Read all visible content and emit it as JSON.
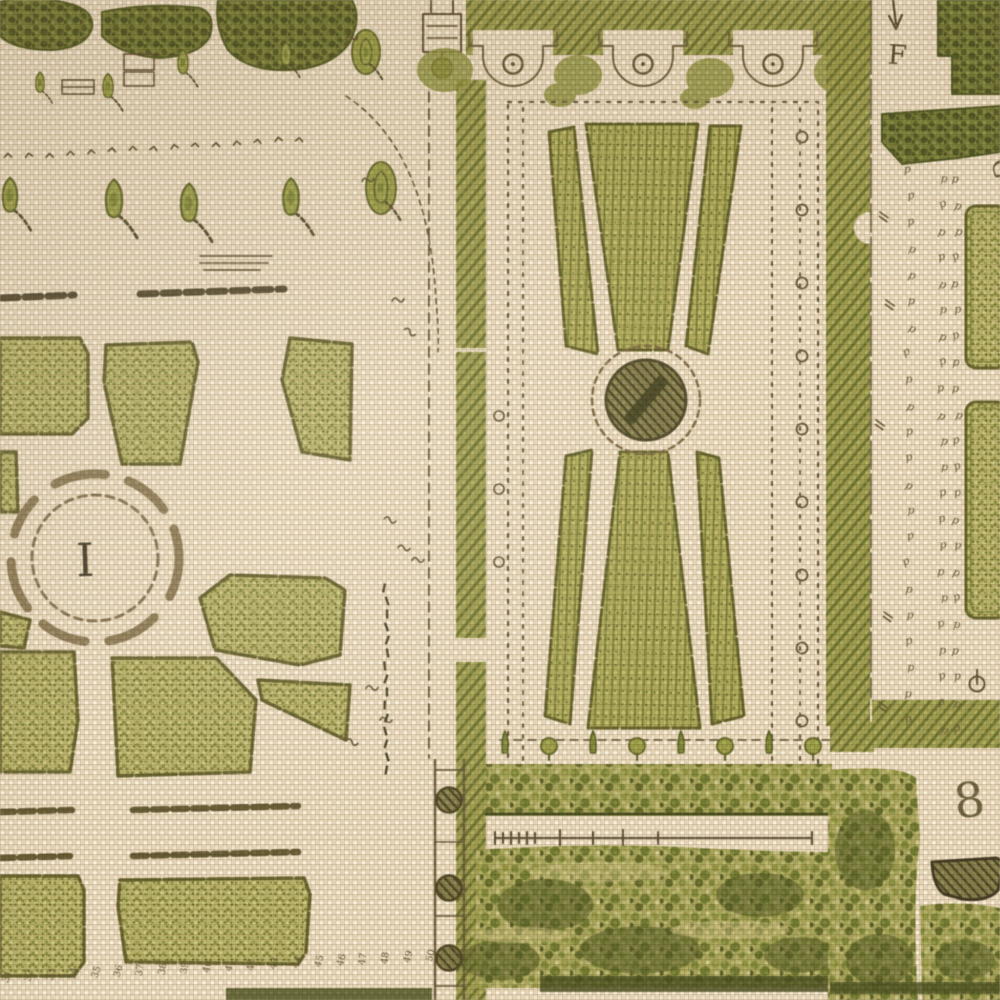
{
  "artifact": {
    "kind": "printed linen fabric close-up",
    "subject": "antique French formal garden plan (baroque parterre map) printed in olive green on natural linen",
    "weave": "plain canvas weave"
  },
  "palette": {
    "linen_base": "#e4d3b5",
    "weave_highlight": "#f6eed9",
    "weave_shadow": "#c9b495",
    "print_pale_green": "#c6cc81",
    "print_mid_green": "#a9b35f",
    "print_deep_green": "#7c8a3e",
    "print_darkest_green": "#55632a",
    "print_olive_ink": "#6b7034",
    "print_brown_ink": "#6b6246",
    "print_text_ink": "#4c4734"
  },
  "labels": {
    "basin_numeral": "I",
    "ref_letter_top_right": "F",
    "ref_letter_right_edge": "G",
    "plot_numeral_right": "8"
  },
  "marks": {
    "tree_symbol_glyph": "p",
    "tree_symbol_rows": 22,
    "chevron_row_count": 15,
    "row_of_small_figures": [
      "31",
      "32",
      "33",
      "34",
      "35",
      "36",
      "37",
      "38",
      "39",
      "40",
      "41",
      "42",
      "43",
      "44",
      "45",
      "46",
      "47",
      "48",
      "49",
      "50"
    ]
  }
}
